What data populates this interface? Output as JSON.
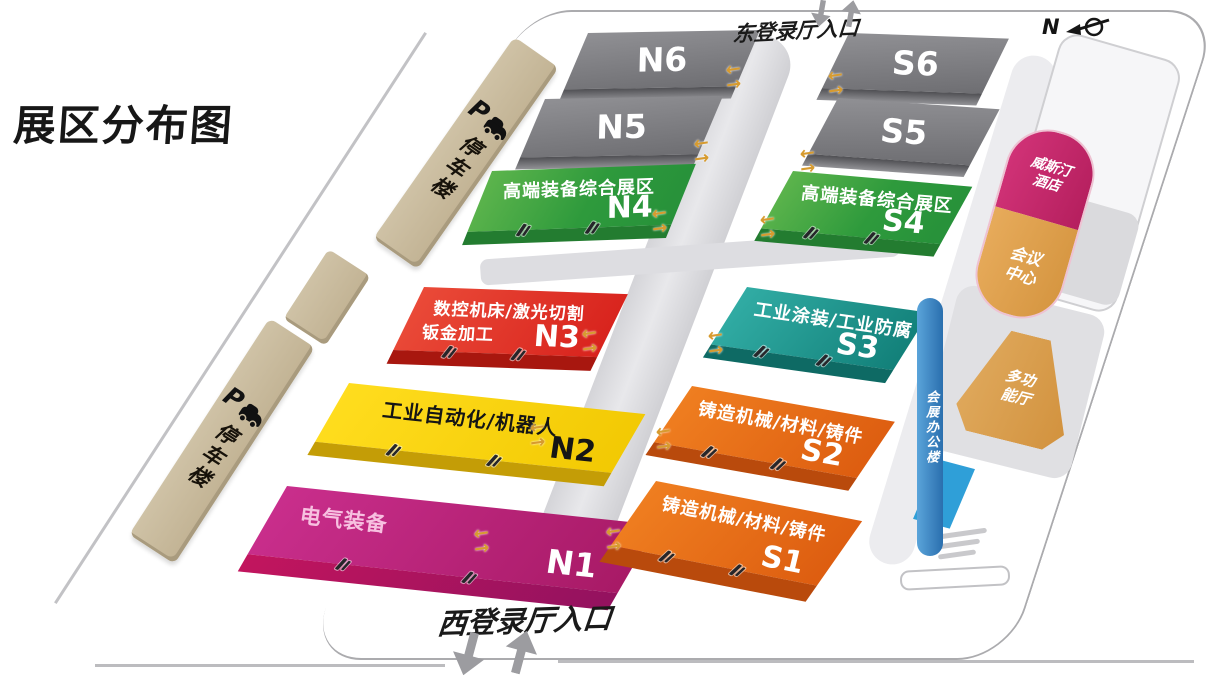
{
  "title": "展区分布图",
  "compass": {
    "label": "N"
  },
  "entrances": {
    "east": {
      "label": "东登录厅入口"
    },
    "west": {
      "label": "西登录厅入口"
    }
  },
  "parking": {
    "icon_letter": "P",
    "upper_label": "停车楼",
    "lower_label": "停车楼"
  },
  "halls": {
    "n6": {
      "code": "N6",
      "label": ""
    },
    "n5": {
      "code": "N5",
      "label": ""
    },
    "n4": {
      "code": "N4",
      "label": "高端装备综合展区"
    },
    "n3": {
      "code": "N3",
      "label": "数控机床/激光切割",
      "label2": "钣金加工"
    },
    "n2": {
      "code": "N2",
      "label": "工业自动化/机器人"
    },
    "n1": {
      "code": "N1",
      "label": "电气装备"
    },
    "s6": {
      "code": "S6",
      "label": ""
    },
    "s5": {
      "code": "S5",
      "label": ""
    },
    "s4": {
      "code": "S4",
      "label": "高端装备综合展区"
    },
    "s3": {
      "code": "S3",
      "label": "工业涂装/工业防腐"
    },
    "s2": {
      "code": "S2",
      "label": "铸造机械/材料/铸件"
    },
    "s1": {
      "code": "S1",
      "label": "铸造机械/材料/铸件"
    }
  },
  "facilities": {
    "hotel": {
      "label": "威斯汀酒店"
    },
    "conference": {
      "label": "会议中心"
    },
    "multifunction": {
      "label": "多功能厅"
    },
    "office": {
      "label": "会展办公楼"
    }
  },
  "icons": {
    "arrow_left": "←",
    "arrow_right": "→"
  },
  "colors": {
    "hall_gray": "#7d7d81",
    "hall_green": "#2e9a3c",
    "hall_red": "#d8231d",
    "hall_yellow": "#f2c903",
    "hall_magenta": "#b81f78",
    "hall_orange": "#e2661a",
    "hall_teal": "#1f968f",
    "parking_tan": "#c9bb9d",
    "hotel_magenta": "#c62a6b",
    "conference_tan": "#dfa04f",
    "multifunction_tan": "#d89f4e",
    "office_blue": "#2e7fc0",
    "gold_arrow": "#d79b2f",
    "corridor_gray": "#dcdce0"
  }
}
